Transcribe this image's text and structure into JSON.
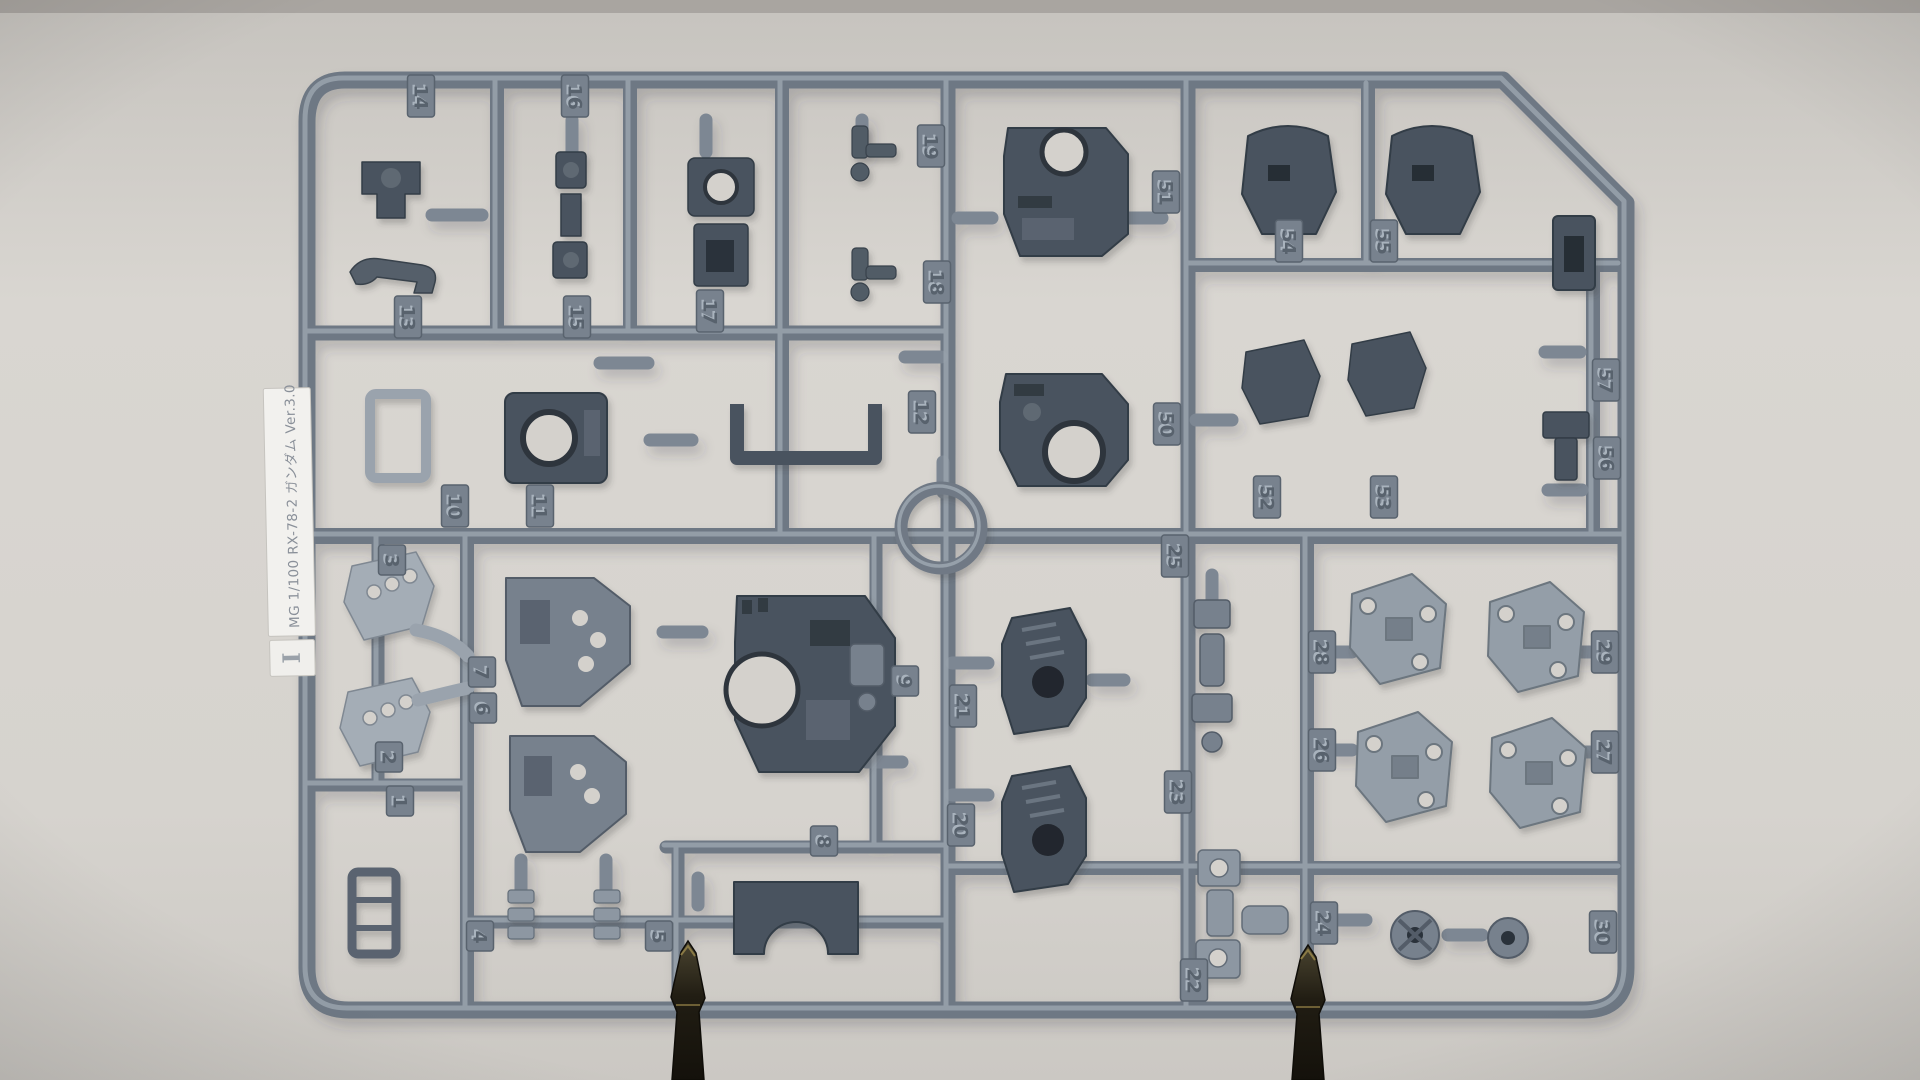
{
  "photo": {
    "subject": "plastic model kit parts runner (sprue) photographed on gray background",
    "kit_label": {
      "text": "MG 1/100 RX-78-2 ガンダム Ver.3.0",
      "runner_letter": "I"
    },
    "colors": {
      "background": "#d7d4cf",
      "plastic_base": "#6e7884",
      "plastic_highlight": "#9aa4ae",
      "part_dark": "#4a535e",
      "part_silver": "#a4adb6",
      "label_white": "#f2f1ee",
      "clip_metal_dark": "#2c281c"
    },
    "clips": {
      "count": 2,
      "description": "alligator clips holding bottom rail"
    },
    "part_tabs": [
      {
        "n": "14",
        "x": 421,
        "y": 96
      },
      {
        "n": "16",
        "x": 575,
        "y": 96
      },
      {
        "n": "19",
        "x": 931,
        "y": 146
      },
      {
        "n": "51",
        "x": 1166,
        "y": 192
      },
      {
        "n": "54",
        "x": 1289,
        "y": 241
      },
      {
        "n": "55",
        "x": 1384,
        "y": 241
      },
      {
        "n": "18",
        "x": 937,
        "y": 282
      },
      {
        "n": "13",
        "x": 408,
        "y": 317
      },
      {
        "n": "15",
        "x": 577,
        "y": 317
      },
      {
        "n": "17",
        "x": 710,
        "y": 311
      },
      {
        "n": "57",
        "x": 1606,
        "y": 380
      },
      {
        "n": "12",
        "x": 922,
        "y": 412
      },
      {
        "n": "50",
        "x": 1167,
        "y": 424
      },
      {
        "n": "56",
        "x": 1607,
        "y": 458
      },
      {
        "n": "52",
        "x": 1267,
        "y": 497
      },
      {
        "n": "53",
        "x": 1384,
        "y": 497
      },
      {
        "n": "10",
        "x": 455,
        "y": 506
      },
      {
        "n": "11",
        "x": 540,
        "y": 506
      },
      {
        "n": "3",
        "x": 392,
        "y": 560
      },
      {
        "n": "25",
        "x": 1175,
        "y": 556
      },
      {
        "n": "7",
        "x": 482,
        "y": 672
      },
      {
        "n": "6",
        "x": 483,
        "y": 708
      },
      {
        "n": "9",
        "x": 905,
        "y": 681
      },
      {
        "n": "21",
        "x": 963,
        "y": 706
      },
      {
        "n": "28",
        "x": 1322,
        "y": 652
      },
      {
        "n": "29",
        "x": 1605,
        "y": 652
      },
      {
        "n": "2",
        "x": 389,
        "y": 757
      },
      {
        "n": "26",
        "x": 1322,
        "y": 750
      },
      {
        "n": "27",
        "x": 1605,
        "y": 752
      },
      {
        "n": "1",
        "x": 400,
        "y": 801
      },
      {
        "n": "23",
        "x": 1178,
        "y": 792
      },
      {
        "n": "20",
        "x": 961,
        "y": 825
      },
      {
        "n": "8",
        "x": 824,
        "y": 841
      },
      {
        "n": "4",
        "x": 480,
        "y": 936
      },
      {
        "n": "5",
        "x": 659,
        "y": 936
      },
      {
        "n": "24",
        "x": 1324,
        "y": 923
      },
      {
        "n": "30",
        "x": 1603,
        "y": 932
      },
      {
        "n": "22",
        "x": 1194,
        "y": 980
      }
    ]
  }
}
